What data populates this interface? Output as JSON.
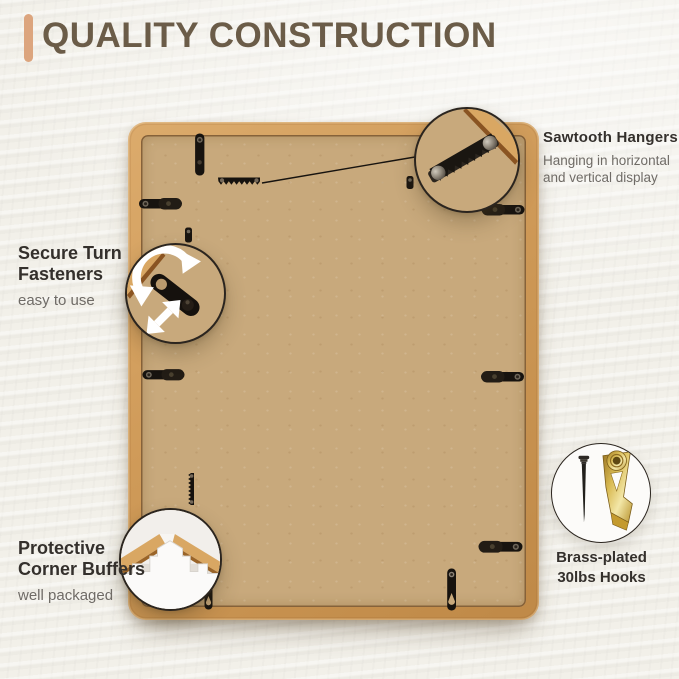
{
  "header": {
    "title": "QUALITY CONSTRUCTION"
  },
  "features": {
    "sawtooth": {
      "title": "Sawtooth Hangers",
      "desc_line1": "Hanging in horizontal",
      "desc_line2": "and vertical display"
    },
    "turn_fasteners": {
      "title_line1": "Secure Turn",
      "title_line2": "Fasteners",
      "desc": "easy to use"
    },
    "corner_buffers": {
      "title_line1": "Protective",
      "title_line2": "Corner Buffers",
      "desc": "well packaged"
    },
    "hooks": {
      "title_line1": "Brass-plated",
      "title_line2": "30lbs Hooks"
    }
  },
  "icons": {
    "rotation_arrow": "↻",
    "slide_arrow": "⇵",
    "sawtooth_hanger": "sawtooth-bar",
    "turn_fastener": "black-capsule-latch",
    "corner_buffer": "white-foam-corner",
    "nail": "black-nail",
    "brass_hook": "gold-picture-hook"
  },
  "colors": {
    "background": "#f2f0e9",
    "accent": "#dca57e",
    "title": "#6b5c48",
    "heading": "#34302c",
    "subtext": "#6f6b66",
    "wood": "#d29c5b",
    "wood_light": "#dcab6c",
    "backboard": "#c8a97c",
    "hardware": "#17130f",
    "brass": "#d4b44e",
    "circle_border": "#2b251f"
  }
}
